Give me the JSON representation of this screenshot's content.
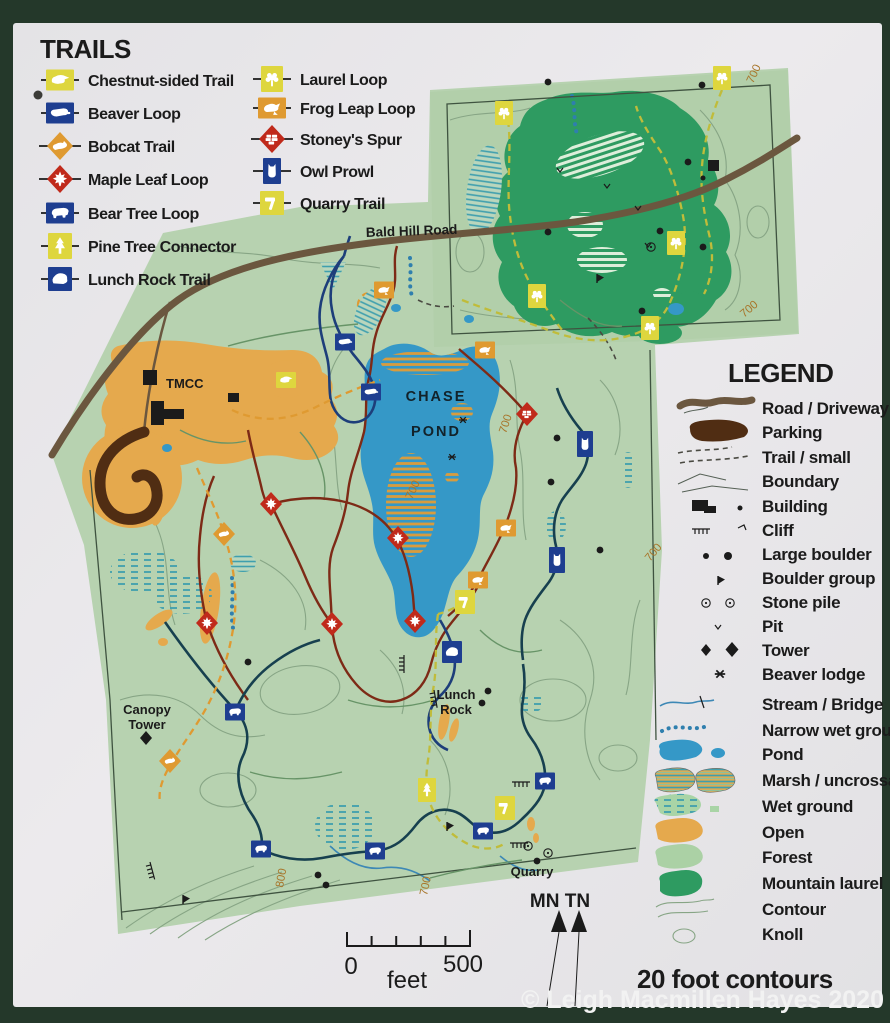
{
  "trails": {
    "title": "TRAILS",
    "items": [
      {
        "label": "Chestnut-sided Trail",
        "icon": "chestnut-sided-bird",
        "shape": "square",
        "color_key": "marker_yellow"
      },
      {
        "label": "Beaver Loop",
        "icon": "beaver",
        "shape": "square",
        "color_key": "marker_blue"
      },
      {
        "label": "Bobcat Trail",
        "icon": "bobcat",
        "shape": "diamond",
        "color_key": "marker_orange"
      },
      {
        "label": "Maple Leaf Loop",
        "icon": "maple-leaf",
        "shape": "diamond",
        "color_key": "marker_red"
      },
      {
        "label": "Bear Tree Loop",
        "icon": "bear",
        "shape": "square",
        "color_key": "marker_blue"
      },
      {
        "label": "Pine Tree Connector",
        "icon": "pine-tree",
        "shape": "square",
        "color_key": "marker_yellow"
      },
      {
        "label": "Lunch Rock Trail",
        "icon": "rock",
        "shape": "square",
        "color_key": "marker_blue"
      },
      {
        "label": "Laurel Loop",
        "icon": "mountain-laurel",
        "shape": "square",
        "color_key": "marker_yellow"
      },
      {
        "label": "Frog Leap Loop",
        "icon": "frog",
        "shape": "square",
        "color_key": "marker_orange"
      },
      {
        "label": "Stoney's Spur",
        "icon": "stone-wall",
        "shape": "diamond",
        "color_key": "marker_red"
      },
      {
        "label": "Owl Prowl",
        "icon": "owl",
        "shape": "square",
        "color_key": "marker_blue"
      },
      {
        "label": "Quarry Trail",
        "icon": "hammer",
        "shape": "square",
        "color_key": "marker_yellow"
      }
    ]
  },
  "legend": {
    "title": "LEGEND",
    "items": [
      {
        "label": "Road / Driveway",
        "symbol": "road"
      },
      {
        "label": "Parking",
        "symbol": "parking"
      },
      {
        "label": "Trail / small",
        "symbol": "trail-small"
      },
      {
        "label": "Boundary",
        "symbol": "boundary"
      },
      {
        "label": "Building",
        "symbol": "building"
      },
      {
        "label": "Cliff",
        "symbol": "cliff"
      },
      {
        "label": "Large boulder",
        "symbol": "large-boulder"
      },
      {
        "label": "Boulder group",
        "symbol": "boulder-group"
      },
      {
        "label": "Stone pile",
        "symbol": "stone-pile"
      },
      {
        "label": "Pit",
        "symbol": "pit"
      },
      {
        "label": "Tower",
        "symbol": "tower"
      },
      {
        "label": "Beaver lodge",
        "symbol": "beaver-lodge"
      },
      {
        "label": "Stream / Bridge",
        "symbol": "stream-bridge"
      },
      {
        "label": "Narrow wet ground",
        "symbol": "narrow-wet-ground"
      },
      {
        "label": "Pond",
        "symbol": "pond"
      },
      {
        "label": "Marsh / uncrossable",
        "symbol": "marsh"
      },
      {
        "label": "Wet ground",
        "symbol": "wet-ground"
      },
      {
        "label": "Open",
        "symbol": "open"
      },
      {
        "label": "Forest",
        "symbol": "forest"
      },
      {
        "label": "Mountain laurel",
        "symbol": "mountain-laurel"
      },
      {
        "label": "Contour",
        "symbol": "contour"
      },
      {
        "label": "Knoll",
        "symbol": "knoll"
      }
    ]
  },
  "map_labels": {
    "road": "Bald Hill Road",
    "pond_line1": "CHASE",
    "pond_line2": "POND",
    "tmcc": "TMCC",
    "canopy_tower_line1": "Canopy",
    "canopy_tower_line2": "Tower",
    "lunch_rock_line1": "Lunch",
    "lunch_rock_line2": "Rock",
    "quarry": "Quarry",
    "contour_700": "700",
    "contour_800": "800"
  },
  "scale_bar": {
    "start": "0",
    "end": "500",
    "unit": "feet"
  },
  "compass": {
    "label": "MN TN"
  },
  "notes": {
    "contours": "20 foot contours"
  },
  "copyright": "© Leigh Macmillen Hayes 2020",
  "colors": {
    "frame": "#24382a",
    "sign": "#e9e8ea",
    "map_green": "#b7d2b0",
    "section_green": "#b2cfaa",
    "laurel_green": "#2e9b61",
    "pond_blue": "#3598c7",
    "marsh_teal": "#3f9fae",
    "open_orange": "#e5a94d",
    "parking_brown": "#502d13",
    "road_brown": "#6b573f",
    "marker_yellow": "#ded63e",
    "marker_blue": "#1e3e90",
    "marker_orange": "#df9a31",
    "marker_red": "#c02a1b",
    "trail_red": "#7d2a16",
    "trail_navy": "#17404f",
    "trail_blue": "#1d3e7a",
    "trail_yellowgreen": "#c0bc3a",
    "contour_line": "#87a585",
    "contour_label": "#a8752a",
    "boundary": "#3f5340",
    "ink": "#1b1b1b",
    "copyright_white": "#f2f2f2"
  }
}
